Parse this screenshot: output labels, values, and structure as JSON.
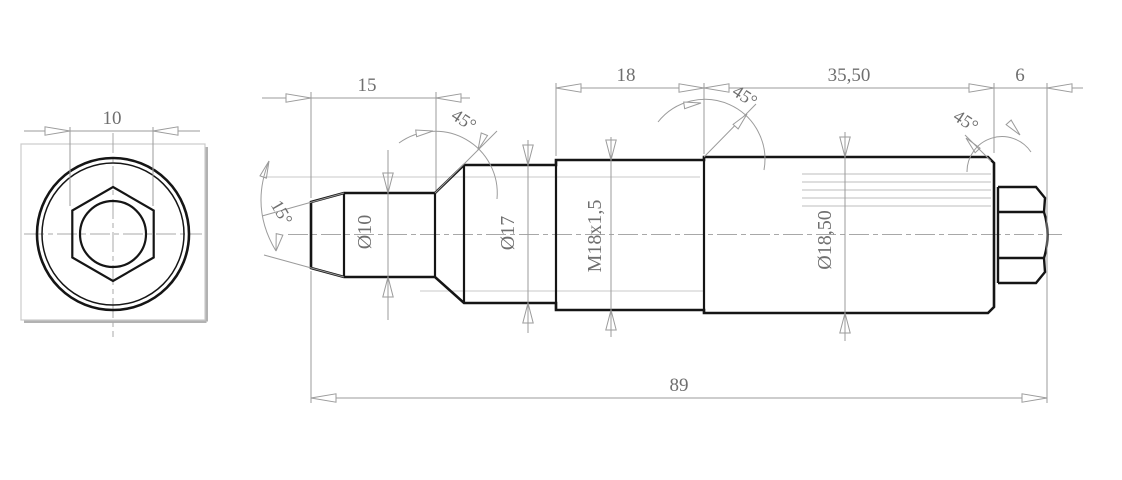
{
  "colors": {
    "background": "#ffffff",
    "outline": "#151515",
    "dimension_lines": "#9b9b9b",
    "text": "#6f6f6f"
  },
  "end_view": {
    "width_across_flats": "10"
  },
  "side_view": {
    "lengths": {
      "tip": "15",
      "thread": "18",
      "body": "35,50",
      "hex": "6",
      "overall": "89"
    },
    "diameters": {
      "tip": "Ø10",
      "collar": "Ø17",
      "thread": "M18x1,5",
      "body": "Ø18,50"
    },
    "angles": {
      "taper": "15°",
      "collar_chamfer": "45°",
      "body_chamfer": "45°",
      "end_chamfer": "45°"
    }
  }
}
